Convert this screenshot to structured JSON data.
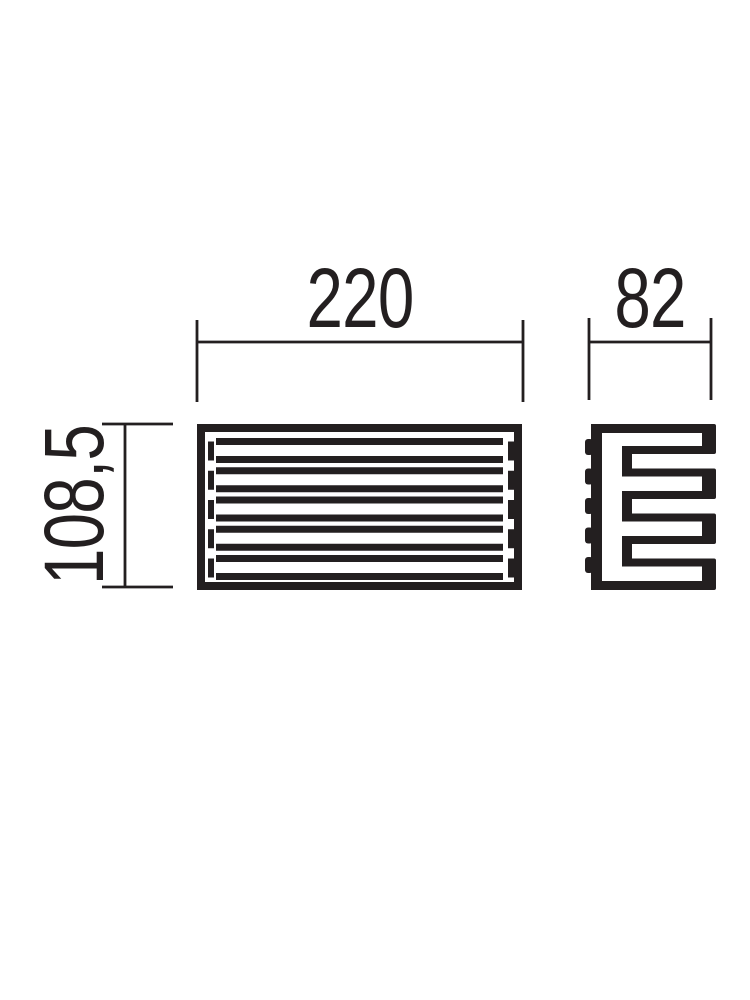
{
  "page": {
    "background": "#ffffff"
  },
  "drawing": {
    "line_color": "#231f20",
    "dimensions": {
      "width": {
        "label": "220"
      },
      "depth": {
        "label": "82"
      },
      "height": {
        "label": "108,5"
      }
    }
  }
}
